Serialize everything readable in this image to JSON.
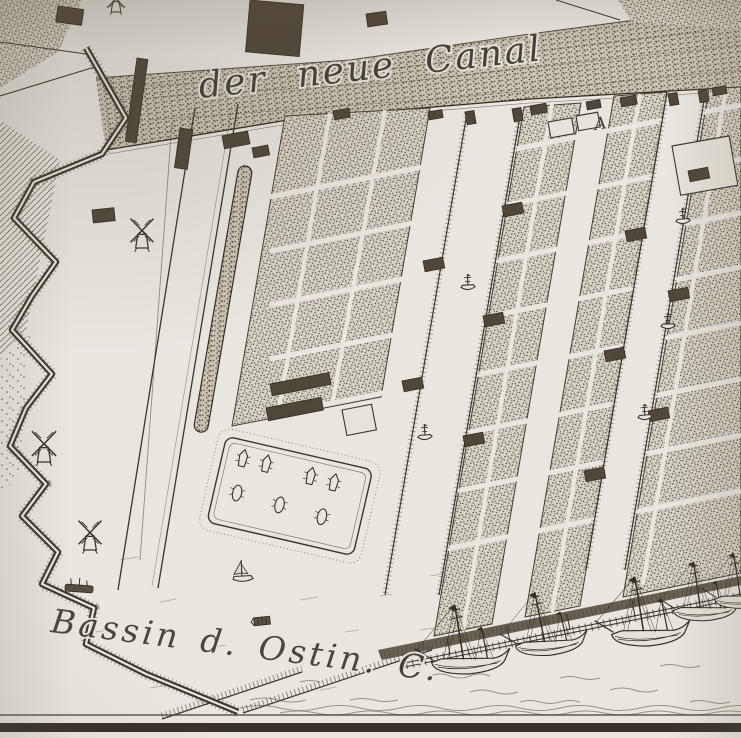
{
  "labels": {
    "canal": "der neue Canal",
    "bassin": "Bassin d. Ostin. C.",
    "index_a": "A"
  },
  "palette": {
    "paper": "#e9e6e0",
    "ink": "#332d24",
    "ink_mid": "#4a4238",
    "ink_light": "#6b6254"
  },
  "features": {
    "windmills": [
      {
        "x": 142,
        "y": 248,
        "s": 1.05
      },
      {
        "x": 44,
        "y": 462,
        "s": 1.1
      },
      {
        "x": 90,
        "y": 550,
        "s": 1.05
      },
      {
        "x": 116,
        "y": 12,
        "s": 0.8
      }
    ],
    "canal_boats": [
      {
        "x": 425,
        "y": 436,
        "r": -4
      },
      {
        "x": 468,
        "y": 286,
        "r": -3
      },
      {
        "x": 683,
        "y": 220,
        "r": -4
      },
      {
        "x": 668,
        "y": 325,
        "r": -2
      },
      {
        "x": 645,
        "y": 416,
        "r": -5
      }
    ],
    "harbor_ships": [
      {
        "x": 468,
        "y": 666,
        "s": 1,
        "r": -4
      },
      {
        "x": 549,
        "y": 648,
        "s": 0.92,
        "r": -6
      },
      {
        "x": 648,
        "y": 638,
        "s": 1,
        "r": -4
      },
      {
        "x": 704,
        "y": 614,
        "s": 0.85,
        "r": -3
      },
      {
        "x": 744,
        "y": 602,
        "s": 0.8,
        "r": -4
      }
    ],
    "bassin_boats": [
      {
        "x": 243,
        "y": 577,
        "kind": "sail",
        "r": -3
      },
      {
        "x": 262,
        "y": 621,
        "kind": "barge",
        "r": -6
      },
      {
        "x": 79,
        "y": 589,
        "kind": "hulk",
        "r": 4
      }
    ],
    "yard_objects": [
      {
        "x": 236,
        "y": 470,
        "kind": "pointed"
      },
      {
        "x": 260,
        "y": 470,
        "kind": "pointed"
      },
      {
        "x": 306,
        "y": 472,
        "kind": "pointed"
      },
      {
        "x": 330,
        "y": 473,
        "kind": "pointed"
      },
      {
        "x": 238,
        "y": 505,
        "kind": "round"
      },
      {
        "x": 282,
        "y": 507,
        "kind": "round"
      },
      {
        "x": 326,
        "y": 509,
        "kind": "round"
      }
    ],
    "buildings": [
      {
        "x": 250,
        "y": 0,
        "w": 54,
        "h": 52,
        "r": 5,
        "t": "dark"
      },
      {
        "x": 366,
        "y": 14,
        "w": 20,
        "h": 13,
        "r": -8,
        "t": "dark"
      },
      {
        "x": 58,
        "y": 6,
        "w": 26,
        "h": 16,
        "r": 8,
        "t": "dark"
      },
      {
        "x": 137,
        "y": 58,
        "w": 11,
        "h": 84,
        "r": 8,
        "t": "dark"
      },
      {
        "x": 180,
        "y": 128,
        "w": 13,
        "h": 40,
        "r": 8,
        "t": "dark"
      },
      {
        "x": 92,
        "y": 210,
        "w": 22,
        "h": 13,
        "r": -6,
        "t": "dark"
      },
      {
        "x": 222,
        "y": 136,
        "w": 26,
        "h": 13,
        "r": -11,
        "t": "dark"
      },
      {
        "x": 252,
        "y": 148,
        "w": 16,
        "h": 10,
        "r": -11,
        "t": "dark"
      },
      {
        "x": 270,
        "y": 384,
        "w": 60,
        "h": 12,
        "r": -11,
        "t": "dark"
      },
      {
        "x": 266,
        "y": 408,
        "w": 56,
        "h": 13,
        "r": -11,
        "t": "dark"
      },
      {
        "x": 342,
        "y": 410,
        "w": 30,
        "h": 26,
        "r": -11,
        "t": "open"
      },
      {
        "x": 548,
        "y": 122,
        "w": 24,
        "h": 16,
        "r": -10,
        "t": "open"
      },
      {
        "x": 576,
        "y": 116,
        "w": 22,
        "h": 15,
        "r": -10,
        "t": "open"
      },
      {
        "x": 672,
        "y": 146,
        "w": 58,
        "h": 50,
        "r": -10,
        "t": "open"
      },
      {
        "x": 333,
        "y": 111,
        "w": 16,
        "h": 9,
        "r": -10,
        "t": "dark"
      },
      {
        "x": 428,
        "y": 112,
        "w": 14,
        "h": 8,
        "r": -10,
        "t": "dark"
      },
      {
        "x": 530,
        "y": 106,
        "w": 16,
        "h": 9,
        "r": -10,
        "t": "dark"
      },
      {
        "x": 586,
        "y": 102,
        "w": 14,
        "h": 8,
        "r": -10,
        "t": "dark"
      },
      {
        "x": 620,
        "y": 98,
        "w": 16,
        "h": 9,
        "r": -10,
        "t": "dark"
      },
      {
        "x": 712,
        "y": 88,
        "w": 14,
        "h": 8,
        "r": -10,
        "t": "dark"
      },
      {
        "x": 465,
        "y": 112,
        "w": 9,
        "h": 13,
        "r": -10,
        "t": "dark"
      },
      {
        "x": 512,
        "y": 109,
        "w": 9,
        "h": 13,
        "r": -10,
        "t": "dark"
      },
      {
        "x": 668,
        "y": 94,
        "w": 9,
        "h": 12,
        "r": -10,
        "t": "dark"
      },
      {
        "x": 698,
        "y": 91,
        "w": 9,
        "h": 12,
        "r": -10,
        "t": "dark"
      },
      {
        "x": 502,
        "y": 206,
        "w": 20,
        "h": 11,
        "r": -11,
        "t": "dark"
      },
      {
        "x": 483,
        "y": 316,
        "w": 20,
        "h": 11,
        "r": -11,
        "t": "dark"
      },
      {
        "x": 463,
        "y": 436,
        "w": 20,
        "h": 11,
        "r": -11,
        "t": "dark"
      },
      {
        "x": 423,
        "y": 261,
        "w": 20,
        "h": 11,
        "r": -11,
        "t": "dark"
      },
      {
        "x": 402,
        "y": 381,
        "w": 20,
        "h": 11,
        "r": -11,
        "t": "dark"
      },
      {
        "x": 688,
        "y": 171,
        "w": 20,
        "h": 11,
        "r": -11,
        "t": "dark"
      },
      {
        "x": 668,
        "y": 291,
        "w": 20,
        "h": 11,
        "r": -11,
        "t": "dark"
      },
      {
        "x": 648,
        "y": 411,
        "w": 20,
        "h": 11,
        "r": -11,
        "t": "dark"
      },
      {
        "x": 625,
        "y": 231,
        "w": 20,
        "h": 11,
        "r": -11,
        "t": "dark"
      },
      {
        "x": 604,
        "y": 351,
        "w": 20,
        "h": 11,
        "r": -11,
        "t": "dark"
      },
      {
        "x": 584,
        "y": 471,
        "w": 20,
        "h": 11,
        "r": -11,
        "t": "dark"
      }
    ]
  }
}
